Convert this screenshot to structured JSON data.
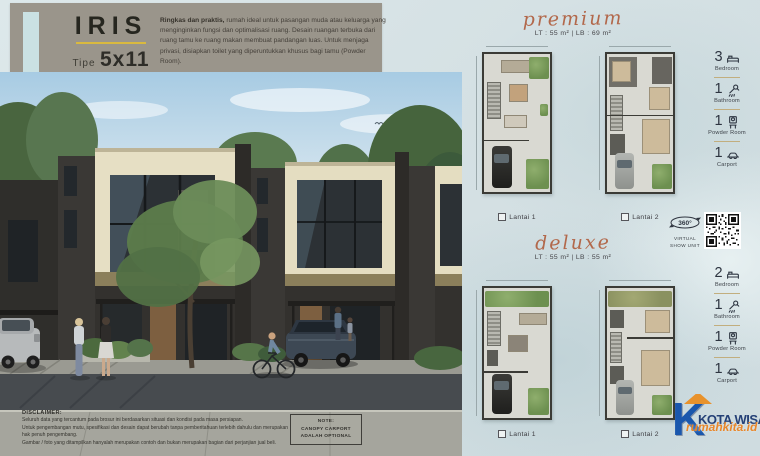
{
  "header": {
    "title": "IRIS",
    "type_prefix": "Tipe",
    "type_value": "5x11",
    "description_bold": "Ringkas dan praktis,",
    "description_rest": " rumah ideal untuk pasangan muda atau keluarga yang menginginkan fungsi dan optimalisasi ruang. Desain ruangan terbuka dari ruang tamu ke ruang makan membuat pandangan luas. Untuk menjaga privasi, disiapkan toilet yang diperuntukkan khusus bagi tamu (Powder Room)."
  },
  "premium": {
    "heading": "premium",
    "specs": "LT : 55 m²  |  LB : 69 m²",
    "floors": [
      {
        "label": "Lantai 1"
      },
      {
        "label": "Lantai 2"
      }
    ],
    "features": [
      {
        "count": "3",
        "label": "Bedroom",
        "icon": "bed-icon"
      },
      {
        "count": "1",
        "label": "Bathroom",
        "icon": "shower-icon"
      },
      {
        "count": "1",
        "label": "Powder Room",
        "icon": "washstand-icon"
      },
      {
        "count": "1",
        "label": "Carport",
        "icon": "car-icon"
      }
    ]
  },
  "deluxe": {
    "heading": "deluxe",
    "specs": "LT : 55 m²  |  LB : 55 m²",
    "floors": [
      {
        "label": "Lantai 1"
      },
      {
        "label": "Lantai 2"
      }
    ],
    "features": [
      {
        "count": "2",
        "label": "Bedroom",
        "icon": "bed-icon"
      },
      {
        "count": "1",
        "label": "Bathroom",
        "icon": "shower-icon"
      },
      {
        "count": "1",
        "label": "Powder Room",
        "icon": "washstand-icon"
      },
      {
        "count": "1",
        "label": "Carport",
        "icon": "car-icon"
      }
    ]
  },
  "virtual_show_unit": {
    "degree": "360°",
    "line1": "VIRTUAL",
    "line2": "SHOW UNIT"
  },
  "disclaimer": {
    "title": "DISCLAIMER:",
    "lines": [
      "Seluruh data yang tercantum pada brosur ini berdasarkan situasi dan kondisi pada masa persiapan.",
      "Untuk pengembangan mutu, spesifikasi dan desain dapat berubah tanpa pemberitahuan terlebih dahulu dan merupakan hak penuh pengembang.",
      "Gambar / foto yang ditampilkan hanyalah merupakan contoh dan bukan merupakan bagian dari perjanjian jual beli."
    ]
  },
  "note": {
    "title": "NOTE:",
    "line1": "CANOPY CARPORT",
    "line2": "ADALAH OPTIONAL"
  },
  "watermark": {
    "initial": "K",
    "brand": "KOTA WISATA",
    "site": "rumahkita.id"
  },
  "colors": {
    "accent_yellow": "#d9b93f",
    "script_accent": "#b2684b",
    "banner_bg": "#9a958b",
    "panel_bg": "#d5e1e4"
  }
}
